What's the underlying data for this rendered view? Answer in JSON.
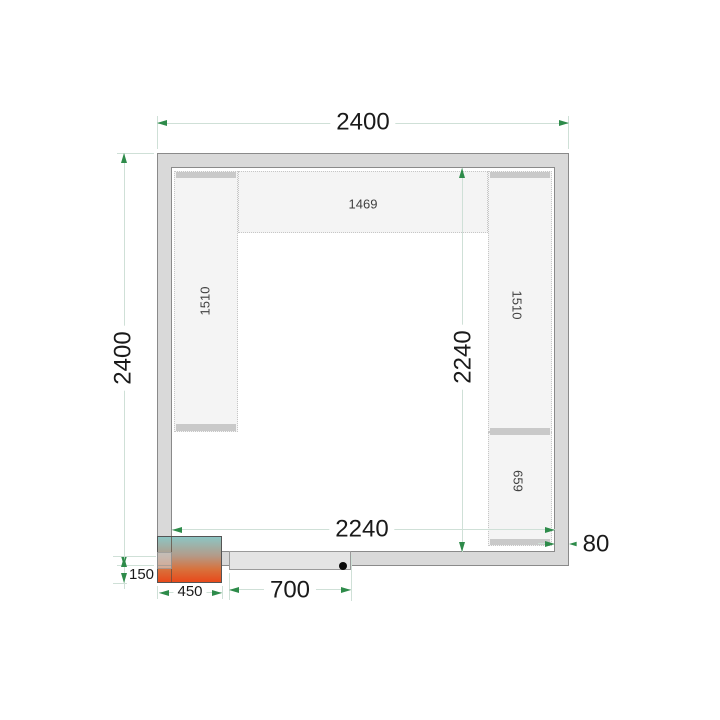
{
  "labels": {
    "outer_width": "2400",
    "outer_height": "2400",
    "inner_width": "2240",
    "inner_height": "2240",
    "wall_thickness": "80",
    "door_width": "700",
    "unit_width": "450",
    "unit_offset": "150",
    "shelf_top": "1469",
    "shelf_left": "1510",
    "shelf_right": "1510",
    "shelf_right_short": "659"
  },
  "colors": {
    "wall_fill": "#d9d9d9",
    "wall_border": "#8a8a8a",
    "shelf_fill": "#f4f4f4",
    "shelf_border_dotted": "#c6c6c6",
    "shelf_support_strip": "#c9c9c9",
    "dimension_line": "#cfe0d7",
    "dimension_arrow": "#2e8b4a",
    "dimension_text": "#1a1a1a",
    "door_leaf": "#e4e4e4",
    "door_handle": "#0a0a0a",
    "unit_gradient_top": "#8cc5c3",
    "unit_gradient_mid": "#d8713c",
    "unit_gradient_bottom": "#e8491a"
  }
}
